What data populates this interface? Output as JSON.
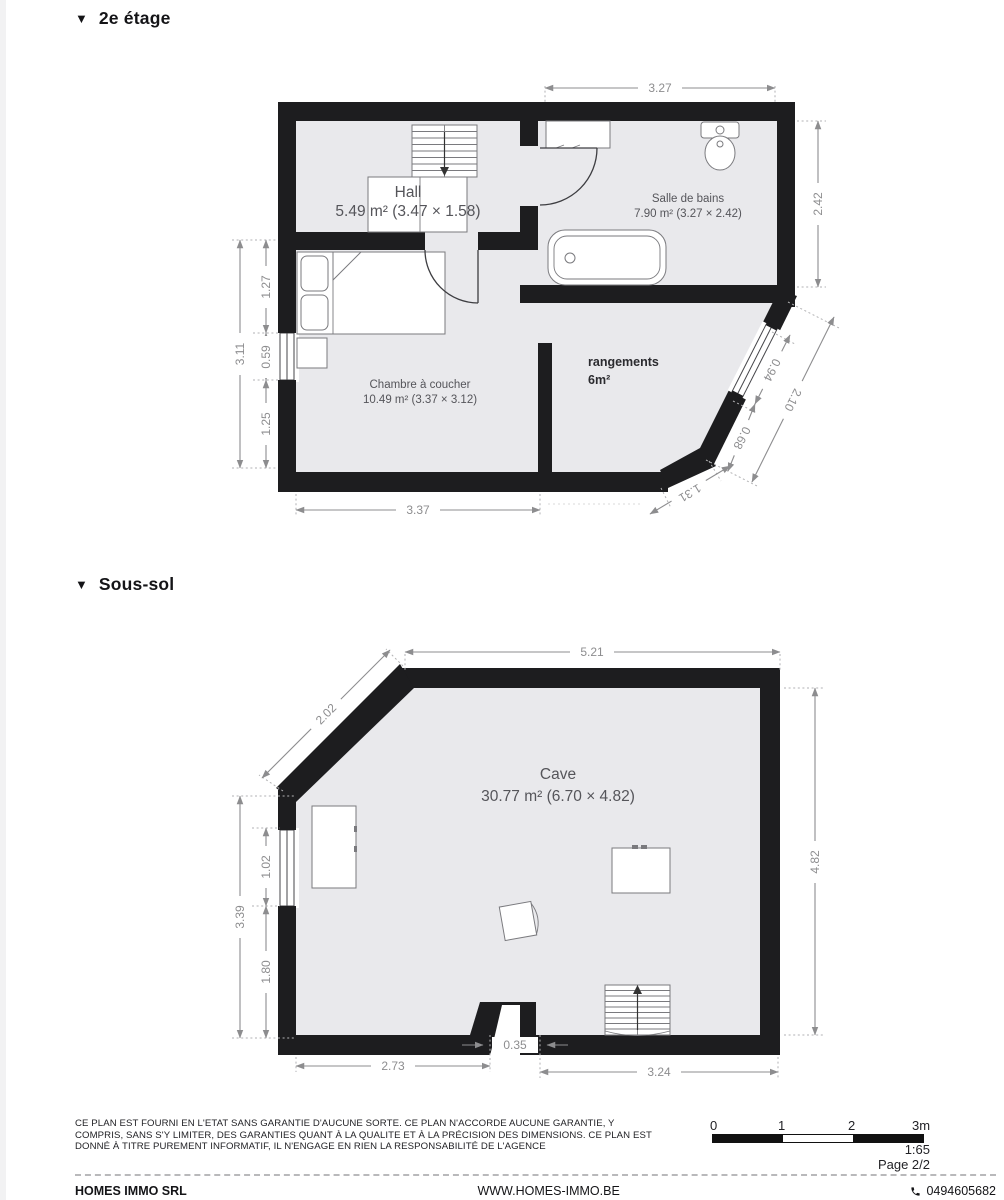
{
  "floor2": {
    "icon": "▼",
    "title": "2e étage",
    "rooms": {
      "hall": {
        "name": "Hall",
        "area": "5.49 m² (3.47 × 1.58)"
      },
      "bathroom": {
        "name": "Salle de bains",
        "area": "7.90 m² (3.27 × 2.42)"
      },
      "bedroom": {
        "name": "Chambre à coucher",
        "area": "10.49 m² (3.37 × 3.12)"
      },
      "storage": {
        "name": "rangements",
        "area": "6m²"
      }
    },
    "dims": {
      "top": "3.27",
      "right": "2.42",
      "left_total": "3.11",
      "left_a": "1.27",
      "left_b": "0.59",
      "left_c": "1.25",
      "bottom": "3.37",
      "diag_window": "0.94",
      "diag_total": "2.10",
      "diag_lower": "0.68",
      "bottom_diag": "1.31"
    }
  },
  "basement": {
    "icon": "▼",
    "title": "Sous-sol",
    "rooms": {
      "cave": {
        "name": "Cave",
        "area": "30.77 m² (6.70 × 4.82)"
      }
    },
    "dims": {
      "top": "5.21",
      "diag": "2.02",
      "right": "4.82",
      "left_total": "3.39",
      "left_a": "1.02",
      "left_b": "1.80",
      "bottom_a": "2.73",
      "door": "0.35",
      "bottom_b": "3.24"
    }
  },
  "footer": {
    "disclaimer_line1": "CE PLAN EST FOURNI EN L'ETAT SANS GARANTIE D'AUCUNE SORTE. CE PLAN N'ACCORDE AUCUNE GARANTIE, Y",
    "disclaimer_line2": "COMPRIS, SANS S'Y LIMITER, DES GARANTIES QUANT À LA QUALITE ET À LA PRÉCISION DES DIMENSIONS. CE PLAN EST",
    "disclaimer_line3": "DONNÉ À TITRE PUREMENT INFORMATIF, IL N'ENGAGE EN RIEN LA RESPONSABILITÉ DE L'AGENCE",
    "scale": {
      "t0": "0",
      "t1": "1",
      "t2": "2",
      "t3": "3m",
      "ratio": "1:65",
      "page": "Page 2/2"
    },
    "company": "HOMES IMMO SRL",
    "website": "WWW.HOMES-IMMO.BE",
    "phone": "0494605682"
  },
  "colors": {
    "wall": "#1d1d1f",
    "room_fill": "#e9e9ec",
    "dimension": "#8d8d8f"
  }
}
